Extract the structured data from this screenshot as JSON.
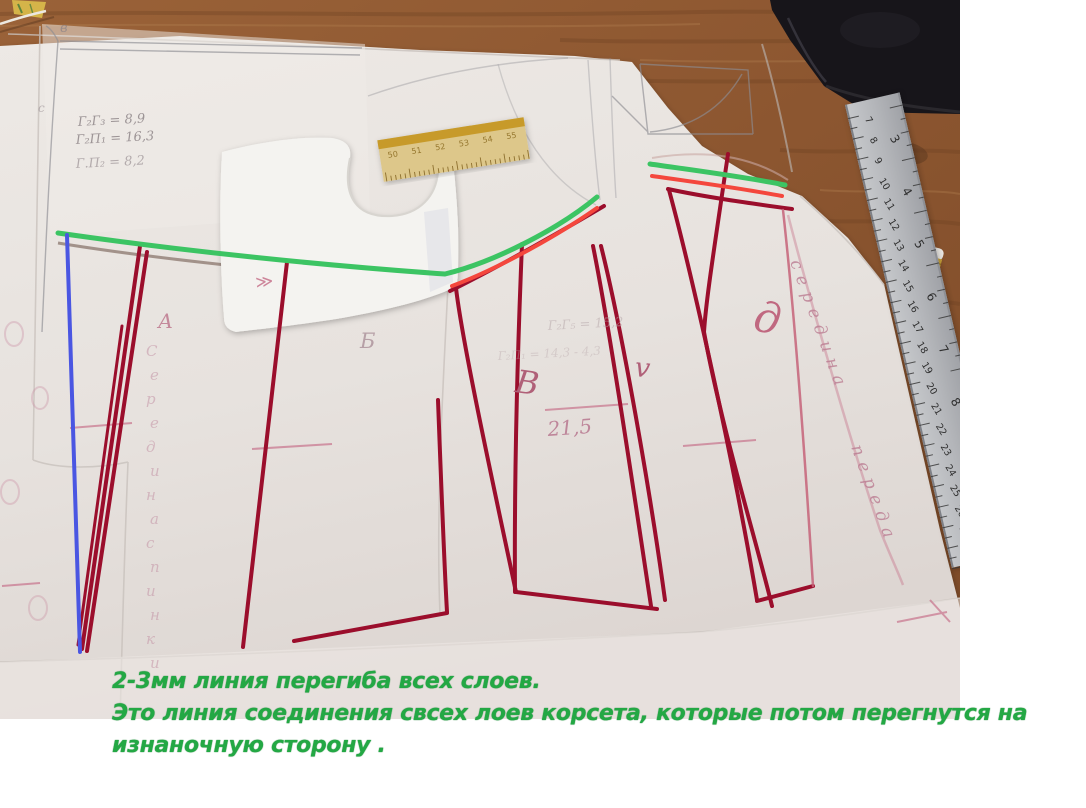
{
  "caption": {
    "line1": "2-3мм линия перегиба всех слоев.",
    "line2": "Это линия соединения свсех лоев корсета, которые потом перегнутся на",
    "line3": "изнаночную сторону ."
  },
  "pencil_notes": {
    "note1": "Г₂Г₃ = 8,9",
    "note2": "Г₂П₁ = 16,3",
    "note3": "Г.П₂ = 8,2",
    "note4": "Г₂Г₅ = 15,2",
    "note5": "Г₂П₁ = 14,3 - 4,3",
    "measure": "21,5"
  },
  "piece_labels": {
    "a": "А",
    "b": "Б",
    "v": "В",
    "c": "v",
    "d": "д",
    "top_small": "в",
    "side_small": "с"
  },
  "vertical_texts": {
    "left": "Середина спинки",
    "right_1": "середина",
    "right_2": "переда"
  },
  "marks": {
    "notch": "≫"
  },
  "metal_ruler": {
    "cm_numbers": [
      "7",
      "8",
      "9",
      "10",
      "11",
      "12",
      "13",
      "14",
      "15",
      "16",
      "17",
      "18",
      "19",
      "20",
      "21",
      "22",
      "23",
      "24",
      "25",
      "26",
      "27",
      "28"
    ],
    "inch_numbers": [
      "3",
      "4",
      "5",
      "6",
      "7",
      "8",
      "9",
      "10"
    ]
  },
  "wooden_ruler": {
    "numbers": [
      "50",
      "51",
      "52",
      "53",
      "54",
      "55"
    ]
  },
  "colors": {
    "annotation_green": "#3cc463",
    "annotation_red": "#f4473d",
    "annotation_blue": "#4a56e2",
    "pattern_dark_red": "#9b0e2c",
    "caption_green": "#23a844"
  }
}
